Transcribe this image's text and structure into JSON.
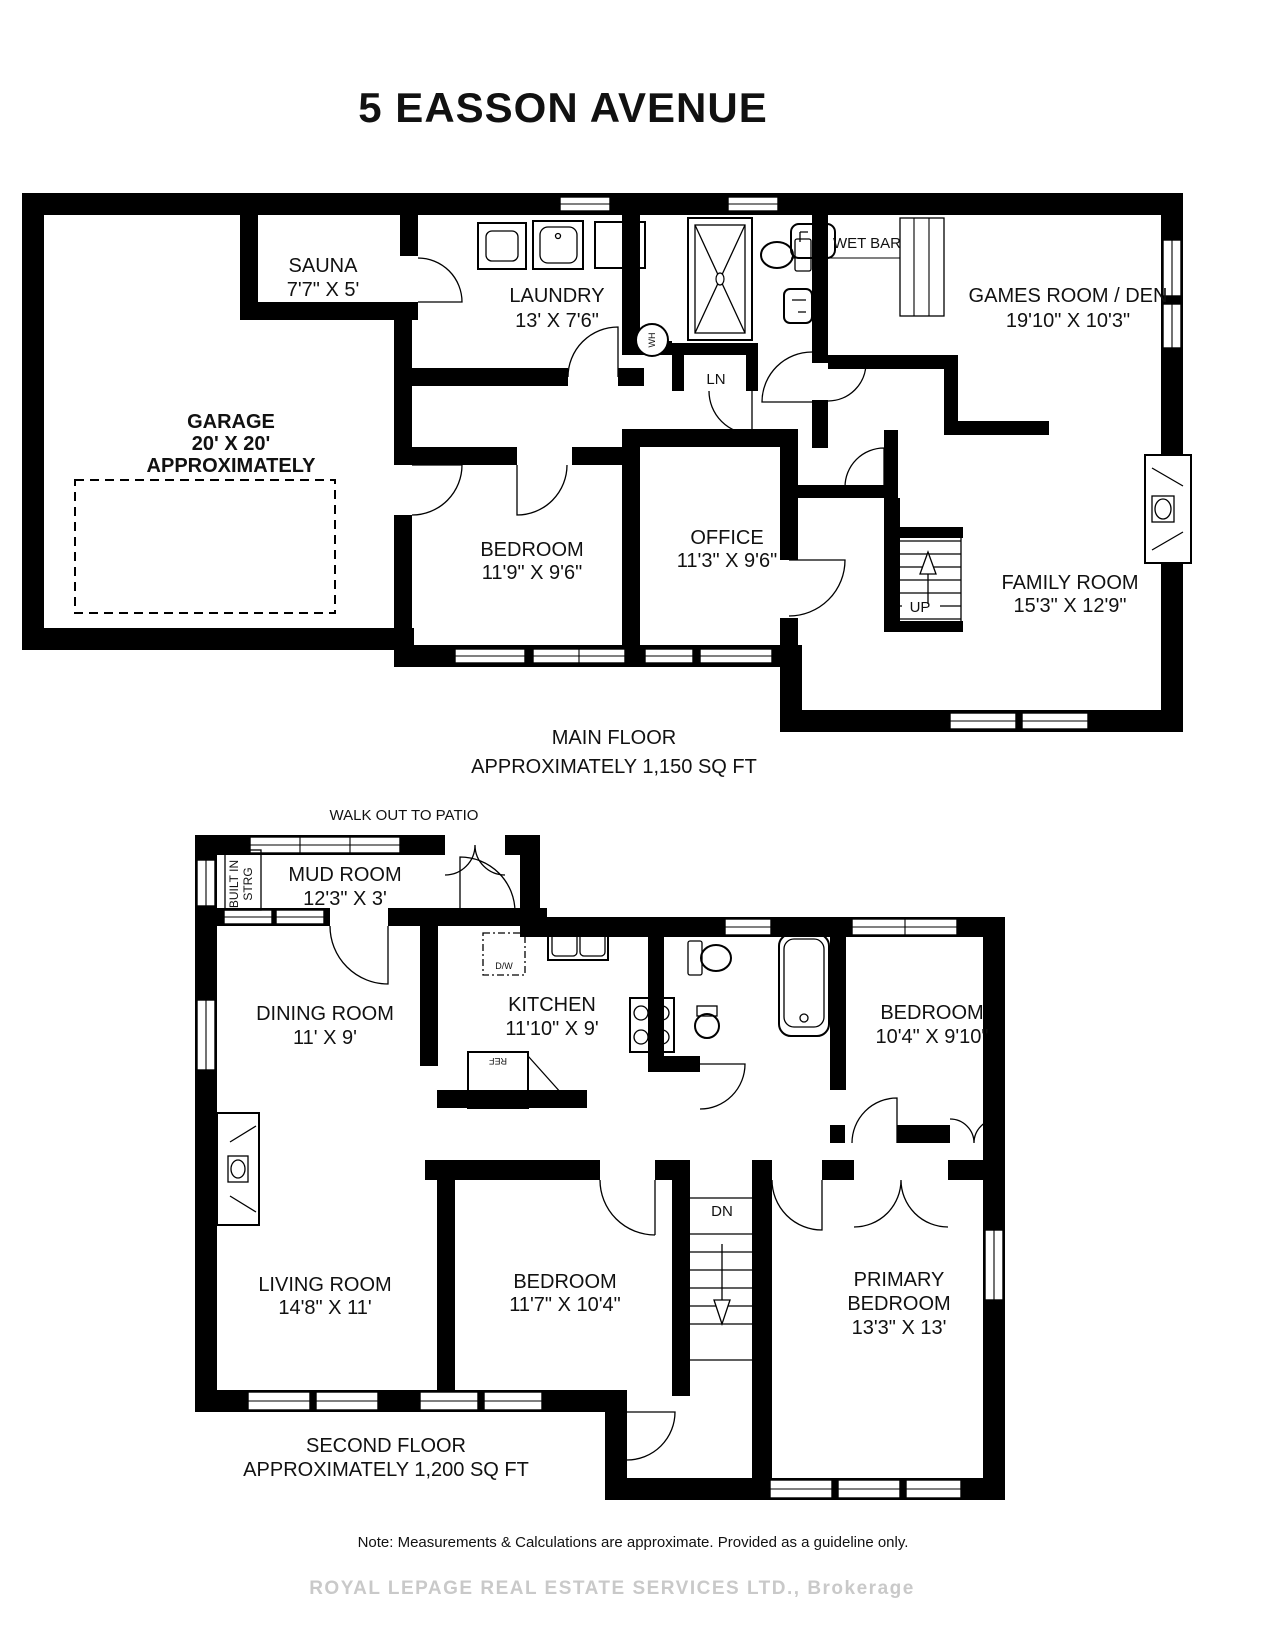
{
  "title": "5 EASSON AVENUE",
  "main_floor": {
    "caption": "MAIN FLOOR",
    "caption2": "APPROXIMATELY 1,150 SQ FT",
    "rooms": {
      "sauna": {
        "name": "SAUNA",
        "dims": "7'7\" X 5'"
      },
      "laundry": {
        "name": "LAUNDRY",
        "dims": "13' X 7'6\""
      },
      "garage": {
        "name": "GARAGE",
        "dims": "20' X 20'",
        "note": "APPROXIMATELY"
      },
      "games_room": {
        "name": "GAMES ROOM / DEN",
        "dims": "19'10\" X 10'3\""
      },
      "bedroom": {
        "name": "BEDROOM",
        "dims": "11'9\" X 9'6\""
      },
      "office": {
        "name": "OFFICE",
        "dims": "11'3\" X 9'6\""
      },
      "family_room": {
        "name": "FAMILY ROOM",
        "dims": "15'3\" X 12'9\""
      }
    },
    "labels": {
      "wet_bar": "WET BAR",
      "wh": "WH",
      "ln": "LN",
      "up": "UP"
    }
  },
  "second_floor": {
    "caption": "SECOND FLOOR",
    "caption2": "APPROXIMATELY 1,200 SQ FT",
    "walkout": "WALK OUT TO PATIO",
    "rooms": {
      "mud_room": {
        "name": "MUD ROOM",
        "dims": "12'3\" X 3'"
      },
      "dining_room": {
        "name": "DINING ROOM",
        "dims": "11' X 9'"
      },
      "kitchen": {
        "name": "KITCHEN",
        "dims": "11'10\" X 9'"
      },
      "bedroom_right": {
        "name": "BEDROOM",
        "dims": "10'4\" X 9'10\""
      },
      "living_room": {
        "name": "LIVING ROOM",
        "dims": "14'8\" X 11'"
      },
      "bedroom_middle": {
        "name": "BEDROOM",
        "dims": "11'7\" X 10'4\""
      },
      "primary_bedroom": {
        "name": "PRIMARY",
        "name2": "BEDROOM",
        "dims": "13'3\" X 13'"
      }
    },
    "labels": {
      "built_in_1": "BUILT IN",
      "built_in_2": "STRG",
      "dw": "D/W",
      "ref": "REF",
      "dn": "DN"
    }
  },
  "footer": {
    "note": "Note: Measurements & Calculations are approximate. Provided as a guideline only.",
    "watermark": "ROYAL LEPAGE REAL ESTATE SERVICES LTD., Brokerage"
  }
}
